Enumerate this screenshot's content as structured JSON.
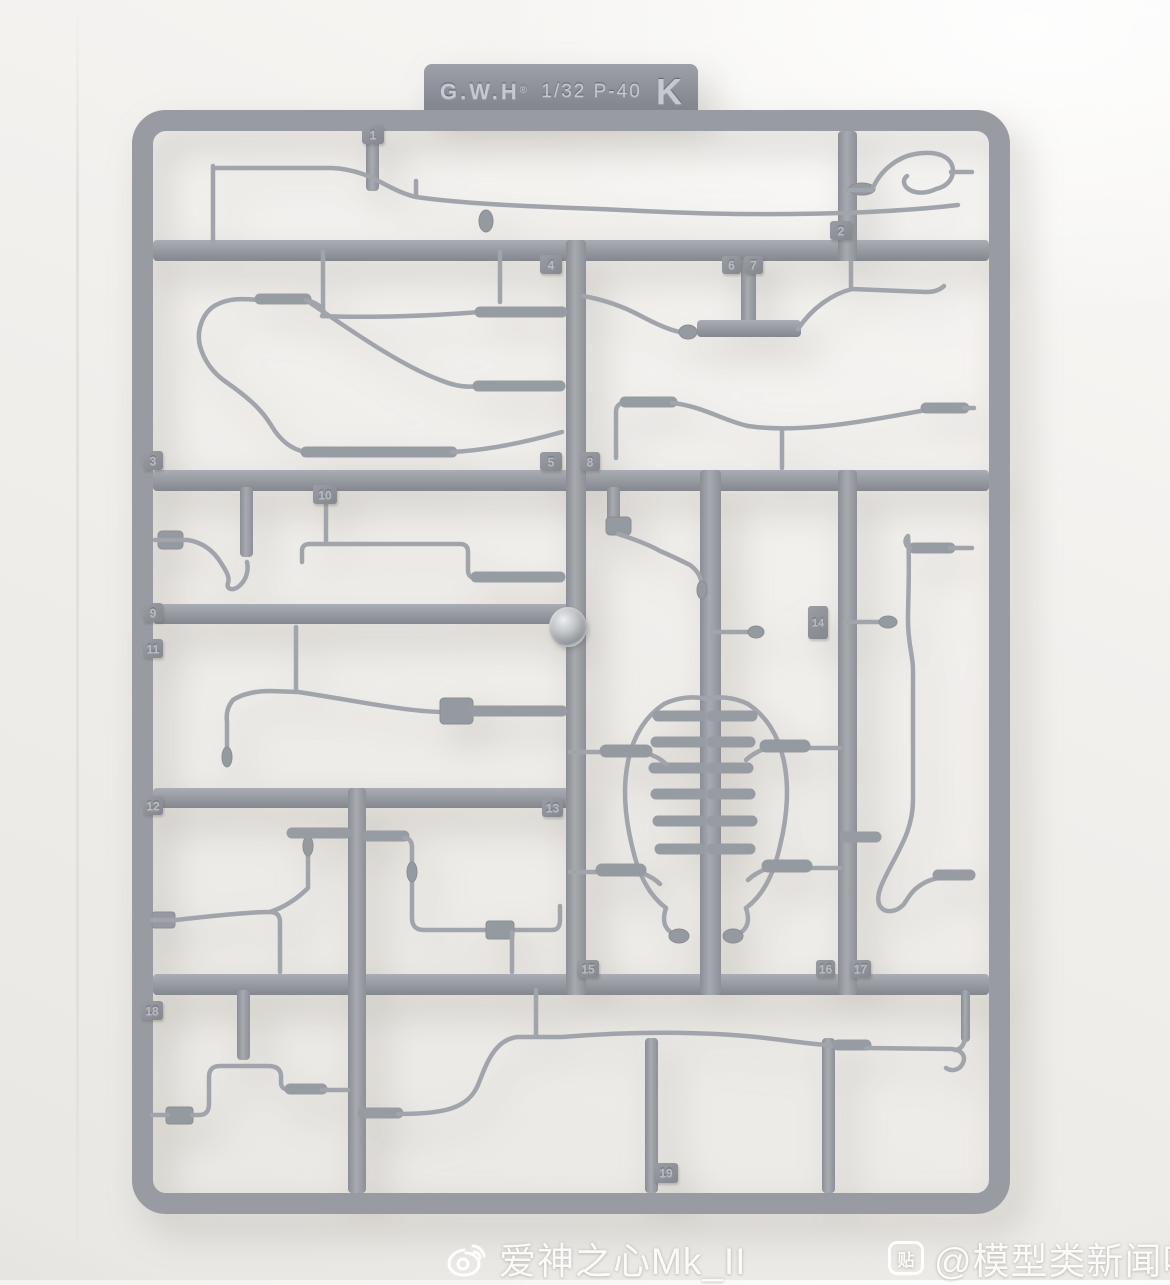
{
  "header_tab": {
    "brand": "G.W.H",
    "mark": "®",
    "scale_model": "1/32 P-40",
    "runner_letter": "K"
  },
  "tags": [
    "1",
    "2",
    "3",
    "4",
    "5",
    "6",
    "7",
    "8",
    "9",
    "10",
    "11",
    "12",
    "13",
    "14",
    "15",
    "16",
    "17",
    "18",
    "19"
  ],
  "watermarks": {
    "left": {
      "icon": "weibo-icon",
      "text": "爱神之心Mk_II"
    },
    "right": {
      "icon": "tieba-icon",
      "badge_glyph": "贴",
      "text": "@模型类新闻吧"
    }
  },
  "colors": {
    "background": "#f1efec",
    "plastic": "#989ba2",
    "plastic_dark": "#84878e",
    "plastic_light": "#aaadb3",
    "tag_face": "#8f929a",
    "watermark": "#ffffff"
  }
}
